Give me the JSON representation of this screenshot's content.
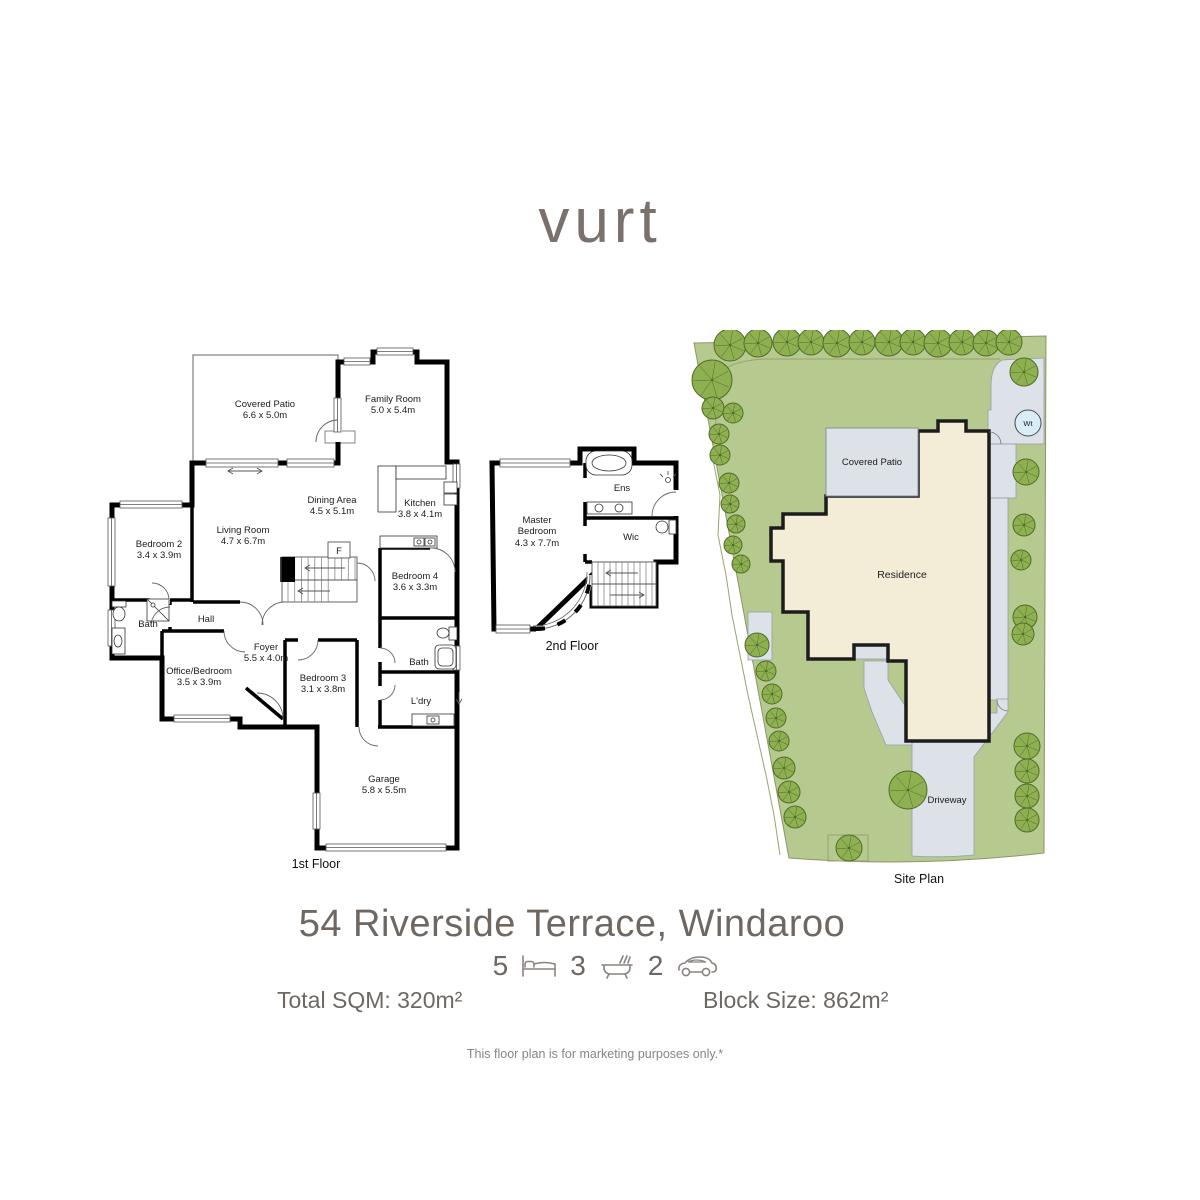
{
  "logo_text": "vurt",
  "floor1": {
    "caption": "1st Floor",
    "rooms": {
      "patio": {
        "name": "Covered Patio",
        "dims": "6.6 x 5.0m"
      },
      "family": {
        "name": "Family Room",
        "dims": "5.0 x 5.4m"
      },
      "dining": {
        "name": "Dining Area",
        "dims": "4.5 x 5.1m"
      },
      "kitchen": {
        "name": "Kitchen",
        "dims": "3.8 x 4.1m"
      },
      "living": {
        "name": "Living Room",
        "dims": "4.7 x 6.7m"
      },
      "bedroom2": {
        "name": "Bedroom 2",
        "dims": "3.4 x 3.9m"
      },
      "bath_left": {
        "name": "Bath"
      },
      "hall": {
        "name": "Hall"
      },
      "foyer": {
        "name": "Foyer",
        "dims": "5.5 x 4.0m"
      },
      "office": {
        "name": "Office/Bedroom",
        "dims": "3.5 x 3.9m"
      },
      "bedroom3": {
        "name": "Bedroom 3",
        "dims": "3.1 x 3.8m"
      },
      "bedroom4": {
        "name": "Bedroom 4",
        "dims": "3.6 x 3.3m"
      },
      "bath_right": {
        "name": "Bath"
      },
      "laundry": {
        "name": "L'dry"
      },
      "garage": {
        "name": "Garage",
        "dims": "5.8 x 5.5m"
      },
      "fridge": {
        "name": "F"
      }
    }
  },
  "floor2": {
    "caption": "2nd Floor",
    "rooms": {
      "master": {
        "name_line1": "Master",
        "name_line2": "Bedroom",
        "dims": "4.3 x 7.7m"
      },
      "ensuite": {
        "name": "Ens"
      },
      "wardrobe": {
        "name": "Wic"
      }
    }
  },
  "site_plan": {
    "caption": "Site Plan",
    "labels": {
      "covered_patio": "Covered Patio",
      "residence": "Residence",
      "driveway": "Driveway",
      "water_tank": "Wt"
    }
  },
  "property": {
    "address": "54 Riverside Terrace, Windaroo",
    "beds": "5",
    "baths": "3",
    "cars": "2",
    "total_sqm": "Total SQM: 320m²",
    "block_size": "Block Size: 862m²",
    "disclaimer": "This floor plan is for marketing purposes only.*"
  },
  "colors": {
    "brand_text": "#7a706c",
    "heading_text": "#6e6762",
    "lawn": "#b6c98e",
    "tree": "#8fb050",
    "tree_line": "#4e6b28",
    "path_gray": "#dde1e8",
    "residence_fill": "#f3edd7",
    "water_tank_fill": "#d8edf6"
  }
}
